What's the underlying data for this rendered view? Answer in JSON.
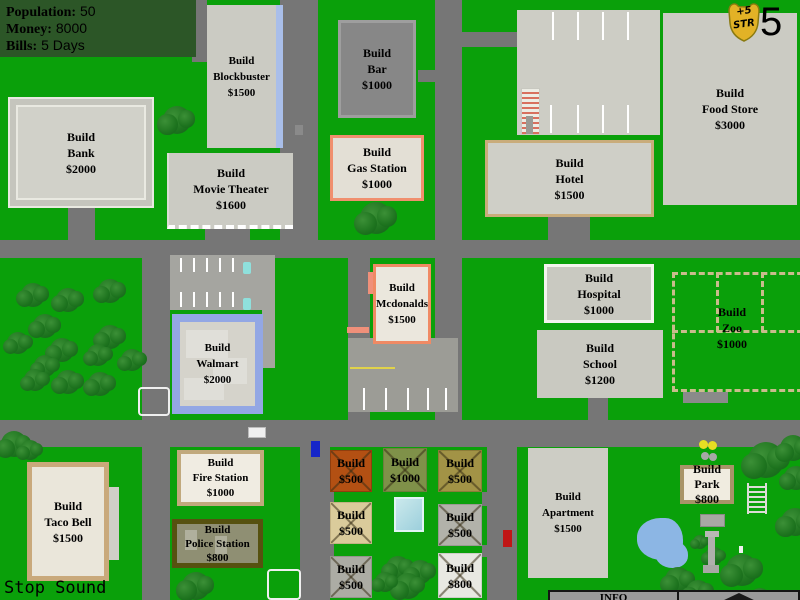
{
  "hud": {
    "stats": [
      {
        "label": "Population:",
        "value": "50"
      },
      {
        "label": "Money:",
        "value": "8000"
      },
      {
        "label": "Bills:",
        "value": "5 Days"
      }
    ],
    "badge": {
      "line1": "+5",
      "line2": "STR"
    },
    "day_counter": "5",
    "sound_toggle_label": "Stop Sound",
    "info_panel_title": "INFO"
  },
  "lots": [
    {
      "id": "blockbuster",
      "label": "Build",
      "title": "Blockbuster",
      "price": "$1500"
    },
    {
      "id": "bar",
      "label": "Build",
      "title": "Bar",
      "price": "$1000"
    },
    {
      "id": "food-store",
      "label": "Build",
      "title": "Food Store",
      "price": "$3000"
    },
    {
      "id": "bank",
      "label": "Build",
      "title": "Bank",
      "price": "$2000"
    },
    {
      "id": "movie-theater",
      "label": "Build",
      "title": "Movie Theater",
      "price": "$1600"
    },
    {
      "id": "gas-station",
      "label": "Build",
      "title": "Gas Station",
      "price": "$1000"
    },
    {
      "id": "hotel",
      "label": "Build",
      "title": "Hotel",
      "price": "$1500"
    },
    {
      "id": "mcdonalds",
      "label": "Build",
      "title": "Mcdonalds",
      "price": "$1500"
    },
    {
      "id": "hospital",
      "label": "Build",
      "title": "Hospital",
      "price": "$1000"
    },
    {
      "id": "zoo",
      "label": "Build",
      "title": "Zoo",
      "price": "$1000"
    },
    {
      "id": "walmart",
      "label": "Build",
      "title": "Walmart",
      "price": "$2000"
    },
    {
      "id": "school",
      "label": "Build",
      "title": "School",
      "price": "$1200"
    },
    {
      "id": "taco-bell",
      "label": "Build",
      "title": "Taco Bell",
      "price": "$1500"
    },
    {
      "id": "fire-station",
      "label": "Build",
      "title": "Fire Station",
      "price": "$1000"
    },
    {
      "id": "police-station",
      "label": "Build",
      "title": "Police Station",
      "price": "$800"
    },
    {
      "id": "apartment",
      "label": "Build",
      "title": "Apartment",
      "price": "$1500"
    },
    {
      "id": "park",
      "label": "Build",
      "title": "Park",
      "price": "$800"
    },
    {
      "id": "small-lot-1",
      "label": "Build",
      "price": "$500"
    },
    {
      "id": "small-lot-2",
      "label": "Build",
      "price": "$1000"
    },
    {
      "id": "small-lot-3",
      "label": "Build",
      "price": "$500"
    },
    {
      "id": "small-lot-4",
      "label": "Build",
      "price": "$500"
    },
    {
      "id": "small-lot-5",
      "label": "Build",
      "price": "$500"
    },
    {
      "id": "small-lot-6",
      "label": "Build",
      "price": "$500"
    },
    {
      "id": "small-lot-7",
      "label": "Build",
      "price": "$800"
    }
  ],
  "colors": {
    "map_green": "#0AA00A",
    "road_gray": "#767676",
    "stats_panel_green": "#2C5627",
    "badge_gold": "#E2B226",
    "pond_blue": "#8CB6E4",
    "pool_cyan": "#BCE2E8",
    "small_lot_tiles": [
      "#B35013",
      "#7F9149",
      "#A29346",
      "#DACB9B",
      "#B2B2AA",
      "#ACACA4",
      "#E8E8E2"
    ]
  }
}
